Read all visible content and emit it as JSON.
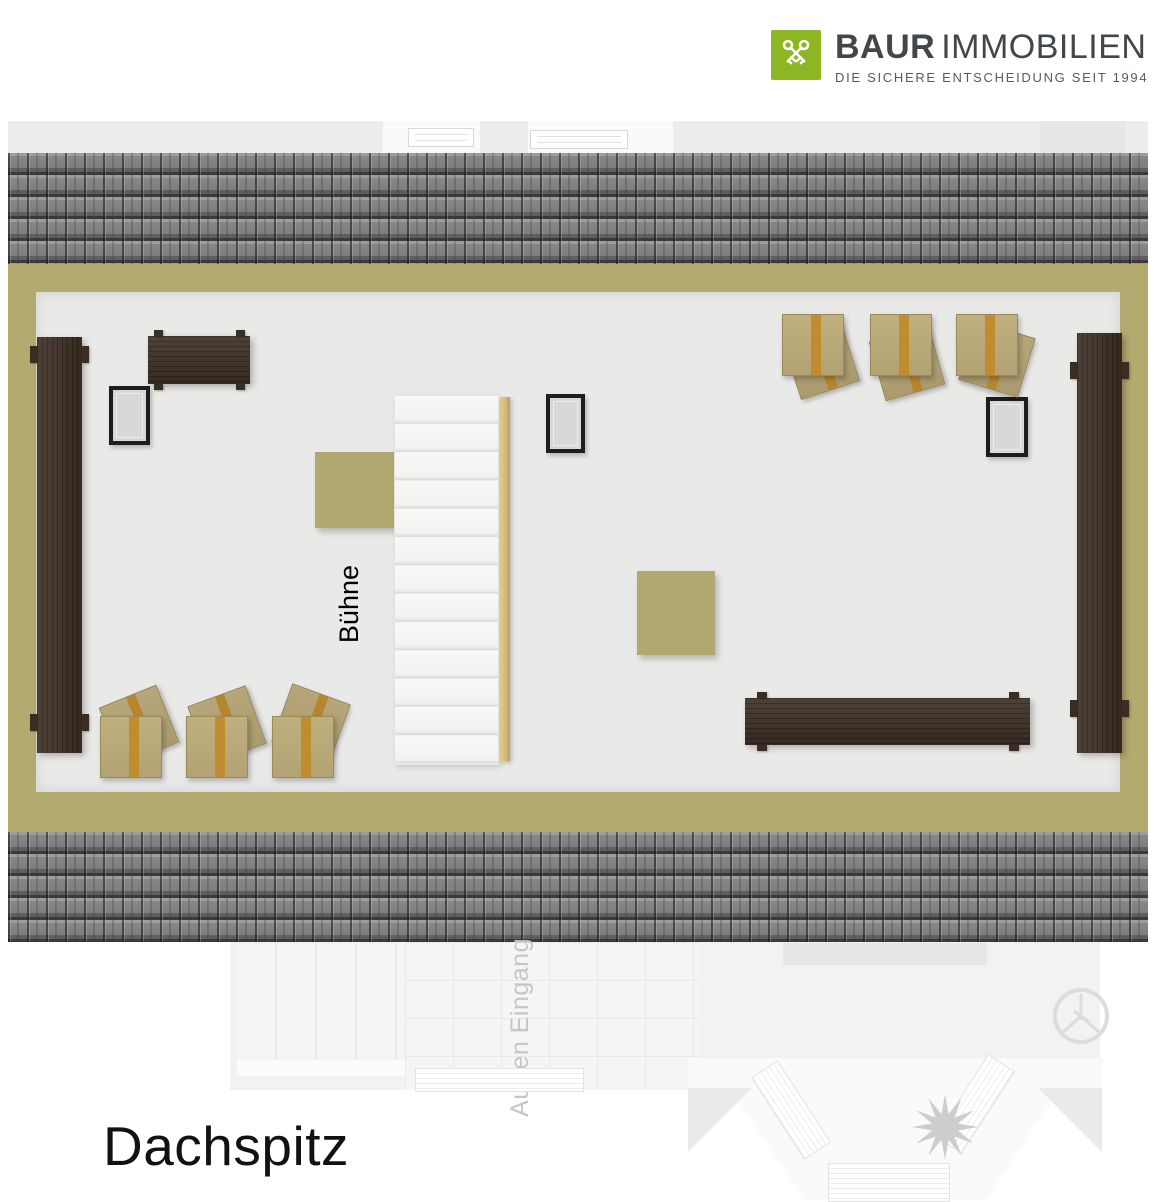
{
  "logo": {
    "brand_bold": "BAUR",
    "brand_light": "IMMOBILIEN",
    "tagline": "DIE SICHERE ENTSCHEIDUNG SEIT 1994",
    "icon": "crossed-keys-icon"
  },
  "floor_plan": {
    "title": "Dachspitz",
    "room_label": "Bühne",
    "ghost_label": "Außen Eingang",
    "furniture": {
      "dark_wood_benches": 4,
      "chair_stacks": 6,
      "stage_blocks": 2,
      "staircase_steps": 13,
      "windows": 3
    },
    "colors": {
      "wall": "#b2aa6e",
      "floor": "#e9e9e7",
      "roof_base": "#8a8a8a",
      "roof_line": "#3a3a3a",
      "wood_dark": "#3b2d22",
      "chair_tan": "#c0af7f",
      "chair_stripe": "#c18c2f",
      "stage_block": "#b1a86f",
      "stair_rail": "#d3b878",
      "window_fill": "#d8d8d6",
      "window_frame": "#1d1d1d",
      "logo_green": "#8cb723",
      "logo_text": "#41474b",
      "ghost_text": "#c6c6c4"
    }
  }
}
